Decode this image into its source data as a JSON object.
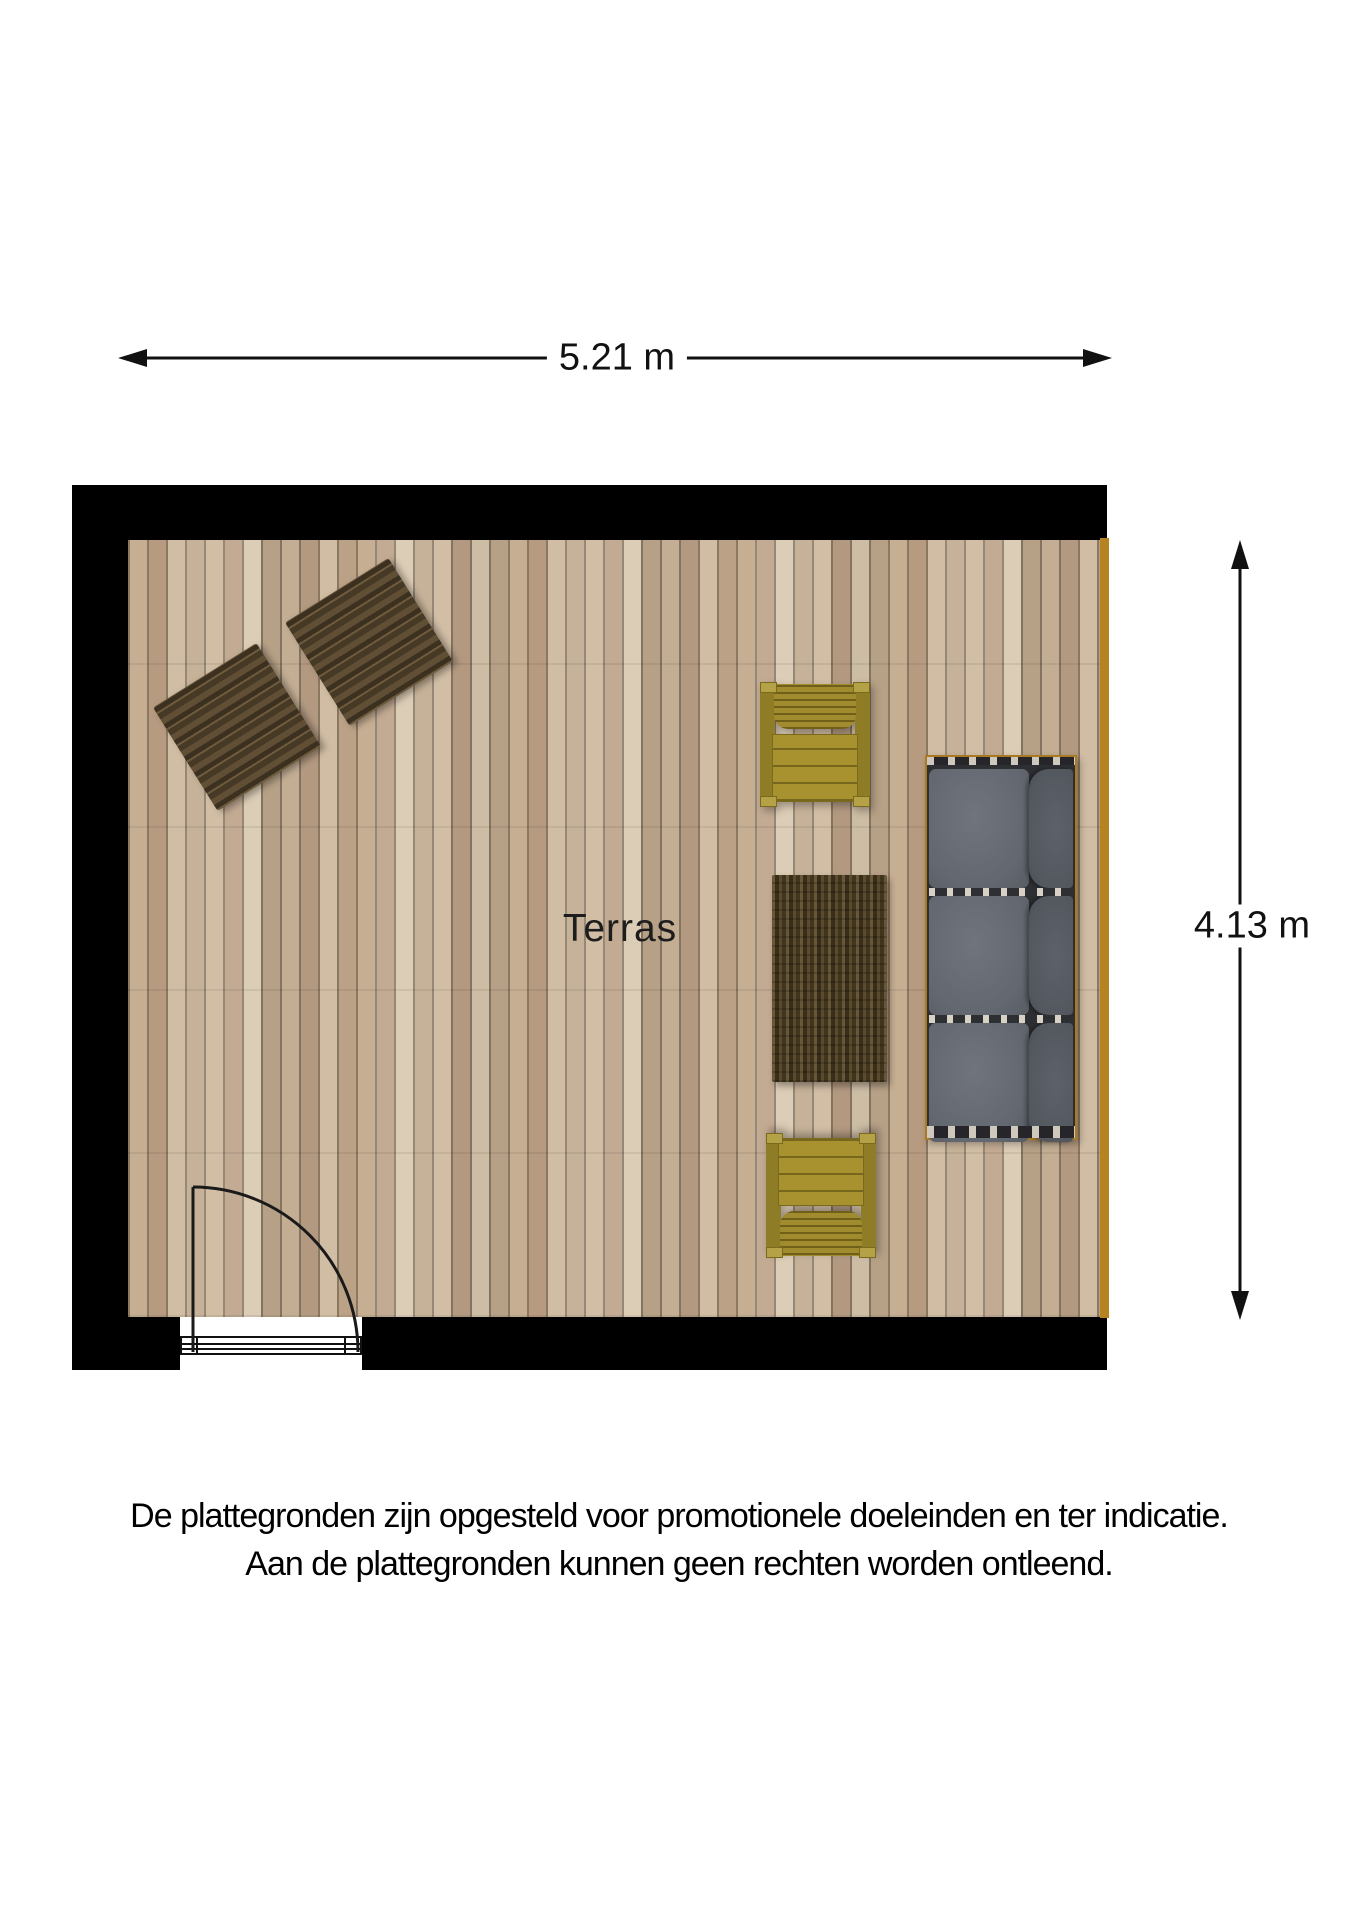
{
  "floorplan": {
    "room_label": "Terras",
    "width_dimension": "5.21 m",
    "height_dimension": "4.13 m",
    "elements": [
      "wall-top",
      "wall-left",
      "wall-bottom-left",
      "wall-bottom-right",
      "deck-floor",
      "deck-edge-strip",
      "lounge-mat-1",
      "lounge-mat-2",
      "armchair-top",
      "armchair-bottom",
      "coffee-table",
      "sofa-three-seats",
      "door-opening",
      "door-threshold",
      "door-leaf",
      "door-swing-arc"
    ]
  },
  "disclaimer": {
    "line1": "De plattegronden zijn opgesteld voor promotionele doeleinden en ter indicatie.",
    "line2": "Aan de plattegronden kunnen geen rechten worden ontleend."
  },
  "colors": {
    "background": "#ffffff",
    "wall": "#000000",
    "floor_base": "#c8b296",
    "plank_gap": "#8a7a66",
    "deck_edge": "#b5831f",
    "mat": "#56462d",
    "chair": "#a8922f",
    "table": "#4e3f24",
    "sofa_seat": "#63676f",
    "sofa_back": "#53575e",
    "sofa_frame": "#a97a22",
    "text": "#111111"
  }
}
